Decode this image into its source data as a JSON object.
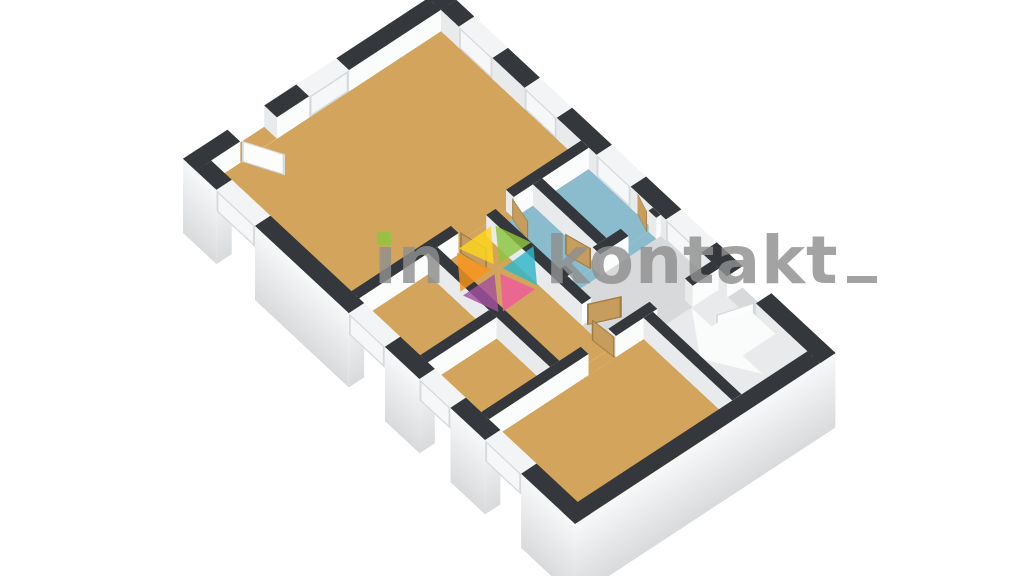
{
  "scene": {
    "type": "3d-floor-plan-render",
    "view": "rotated-isometric-from-southwest",
    "background": "#ffffff"
  },
  "watermark": {
    "prefix": "in",
    "suffix": "kontakt",
    "text_color": "#8f8f8f",
    "i_dot_color": "#8dc63f",
    "logo_petal_colors": [
      "#fdd71e",
      "#8dc63f",
      "#2fb7c8",
      "#ee5a9e",
      "#a4519f",
      "#f7941d"
    ]
  },
  "palette": {
    "wall_top": "#34383c",
    "wall_face_bright": "#fbfcfc",
    "wall_face_shaded": "#e8eaec",
    "exterior_face_dark": "#d8dadc",
    "exterior_face_light": "#f7f8f9",
    "floor_wood": "#d3a45c",
    "floor_tile_blue": "#8abccd",
    "floor_gray": "#d7d9da",
    "door_wood": "#c79d5e",
    "door_wood_edge": "#a07b41",
    "door_white": "#fdfdfe",
    "door_white_edge": "#d3d7d9",
    "window_frame_face": "#f5f7f8",
    "window_frame_edge": "#d6dadc",
    "window_top": "#f3f4f5",
    "stairs_base": "#e9eaeb",
    "stairs_arrow": "#fafbfb"
  },
  "rooms": [
    {
      "id": "living-room",
      "floor": "floor_wood"
    },
    {
      "id": "bedroom-west-1",
      "floor": "floor_wood"
    },
    {
      "id": "bedroom-west-2",
      "floor": "floor_wood"
    },
    {
      "id": "hallway",
      "floor": "floor_wood"
    },
    {
      "id": "toilet",
      "floor": "floor_tile_blue"
    },
    {
      "id": "bathroom",
      "floor": "floor_tile_blue"
    },
    {
      "id": "landing",
      "floor": "floor_gray"
    },
    {
      "id": "stairwell",
      "floor": "floor_gray"
    },
    {
      "id": "bedroom-south",
      "floor": "floor_wood"
    }
  ],
  "elements": {
    "windows": 9,
    "exterior_doors": 2,
    "interior_wood_doors": 6,
    "staircase": "winder-stairs-with-arrow"
  }
}
